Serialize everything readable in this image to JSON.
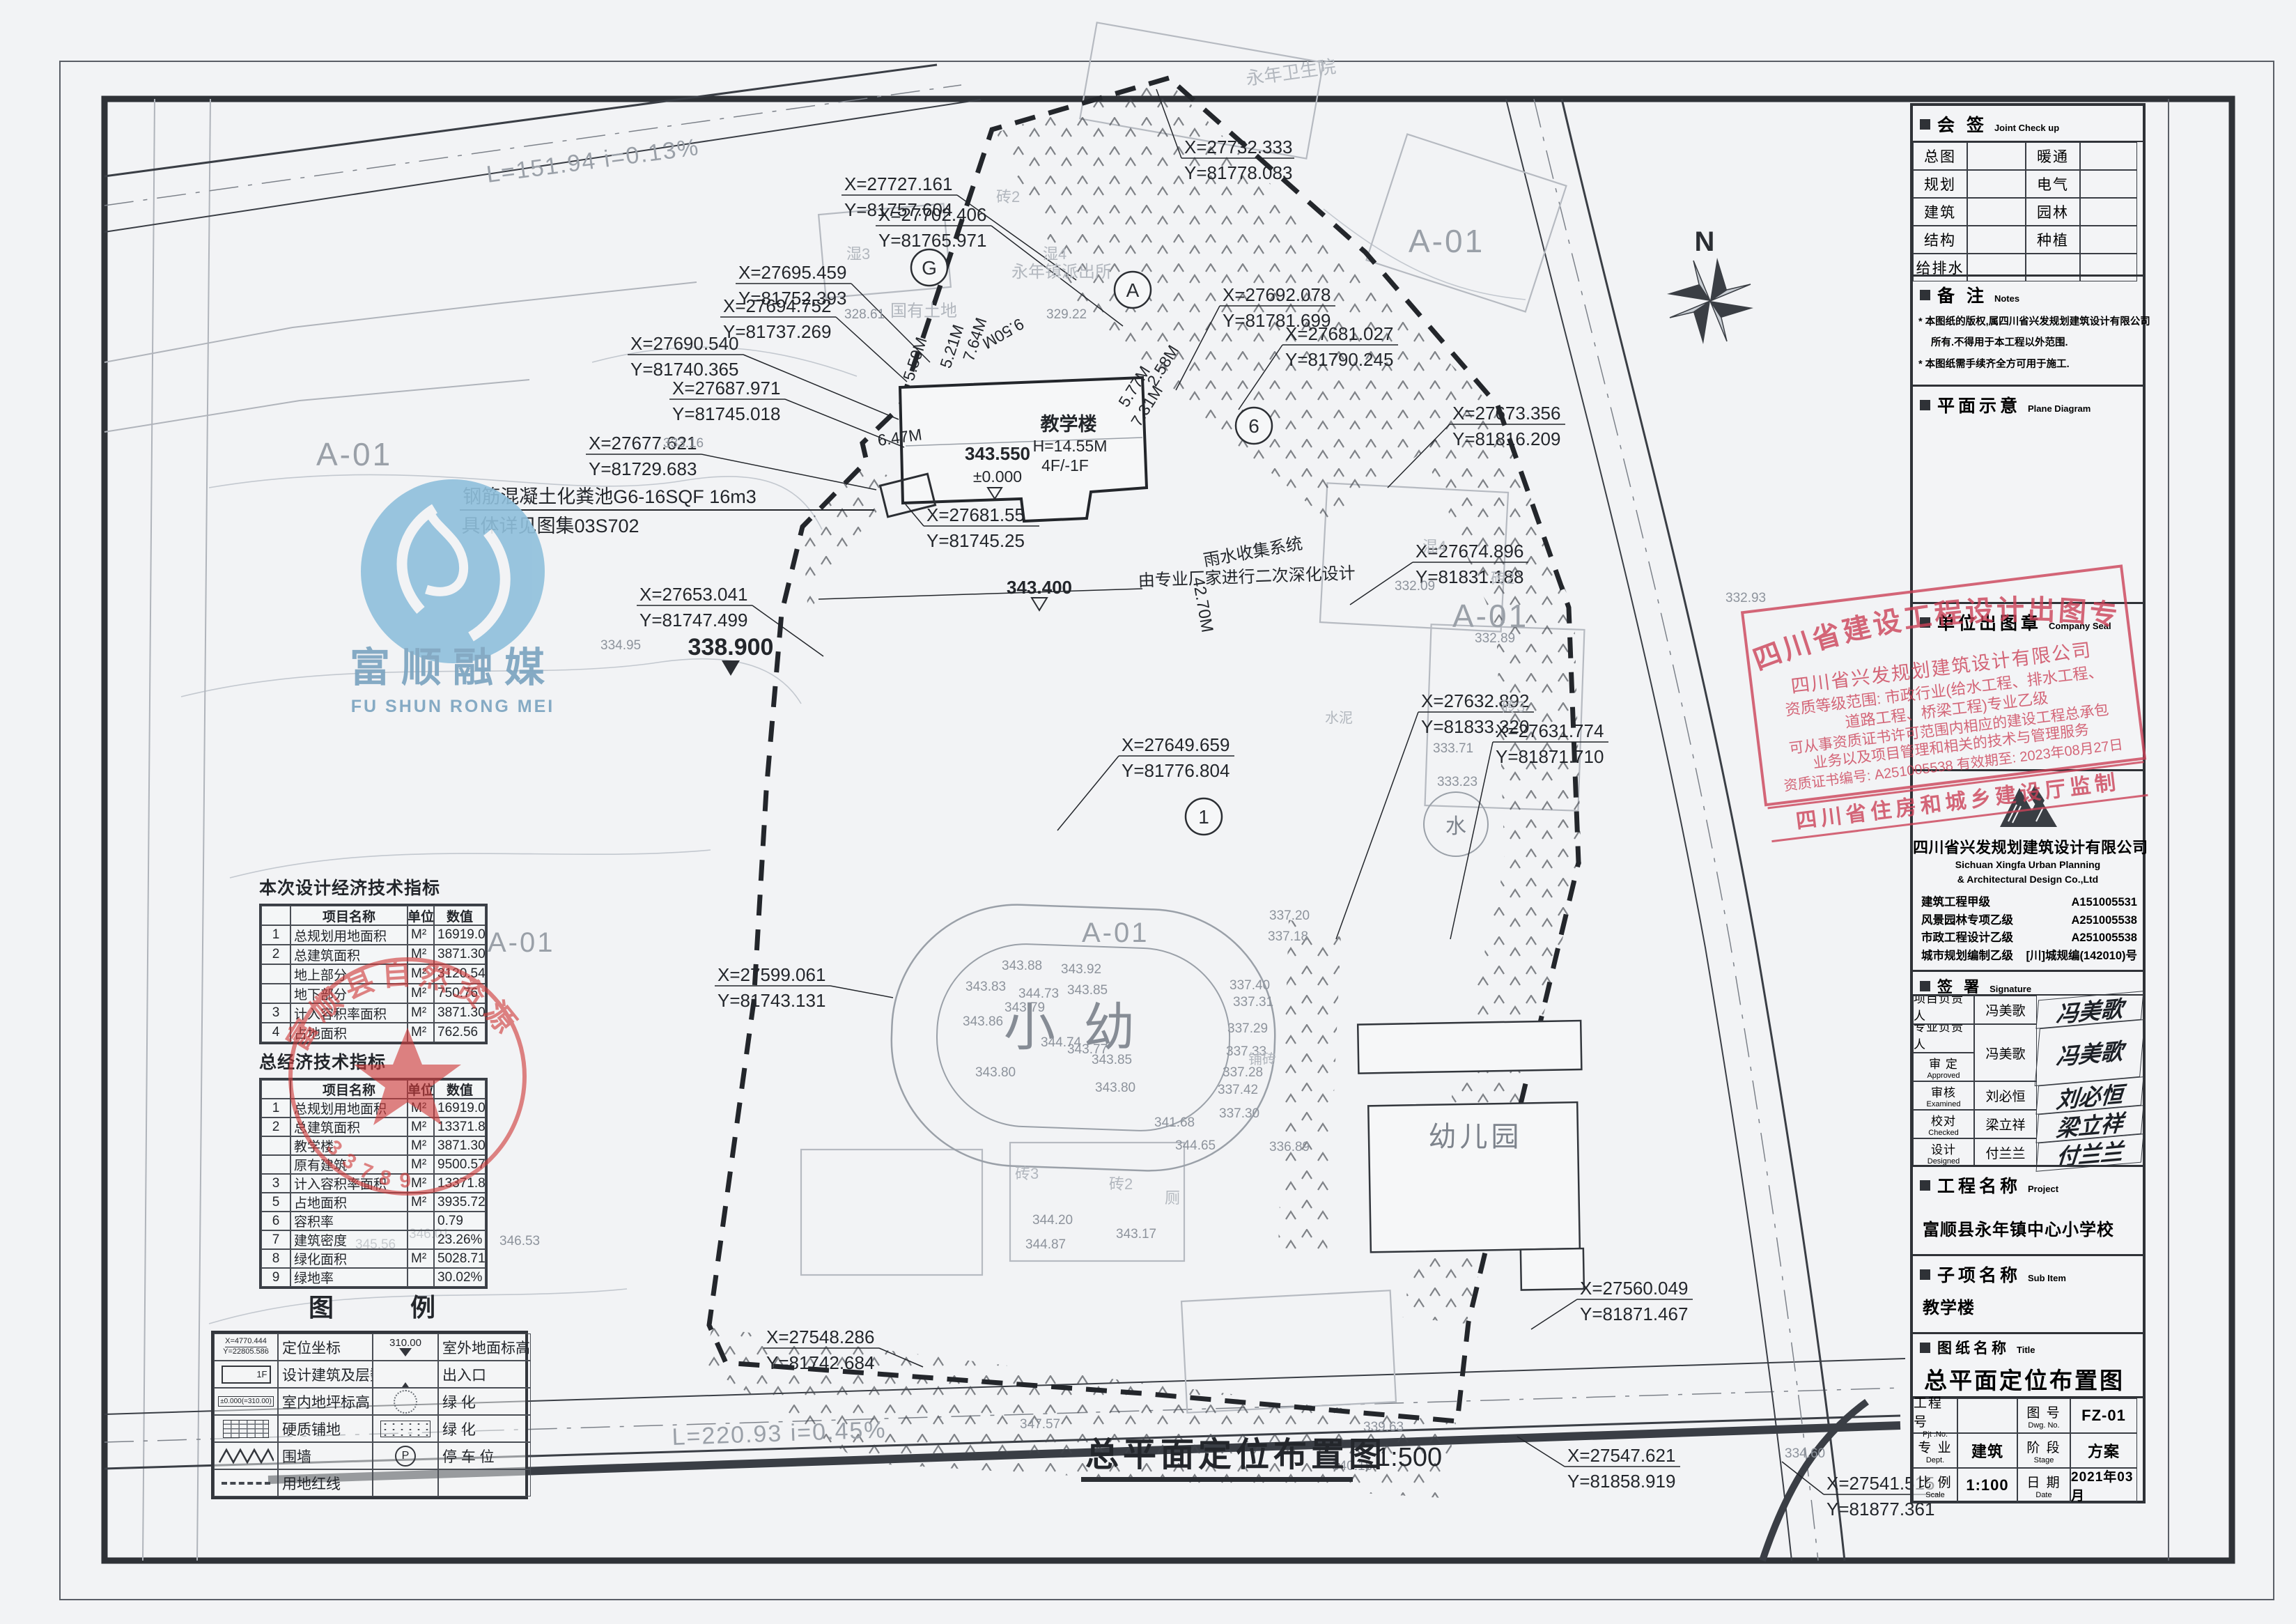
{
  "joint": {
    "hcn": "会 签",
    "hen": "Joint Check up",
    "left": [
      "总图",
      "规划",
      "建筑",
      "结构",
      "给排水"
    ],
    "right": [
      "暖通",
      "电气",
      "园林",
      "种植",
      ""
    ]
  },
  "notes": {
    "hcn": "备 注",
    "hen": "Notes",
    "lines": [
      "* 本图纸的版权,属四川省兴发规划建筑设计有限公司",
      "所有.不得用于本工程以外范围.",
      "* 本图纸需手续齐全方可用于施工."
    ]
  },
  "plane": {
    "hcn": "平面示意",
    "hen": "Plane Diagram"
  },
  "seal": {
    "hcn": "单位出图章",
    "hen": "Company Seal"
  },
  "company": {
    "cn": "四川省兴发规划建筑设计有限公司",
    "en1": "Sichuan Xingfa Urban Planning",
    "en2": "& Architectural Design Co.,Ltd",
    "certs": [
      {
        "l": "建筑工程甲级",
        "n": "A151005531"
      },
      {
        "l": "风景园林专项乙级",
        "n": "A251005538"
      },
      {
        "l": "市政工程设计乙级",
        "n": "A251005538"
      },
      {
        "l": "城市规划编制乙级",
        "n": "[川]城规编(142010)号"
      }
    ]
  },
  "sign": {
    "hcn": "签 署",
    "hen": "Signature",
    "roles": [
      {
        "cn": "项目负责人",
        "en": "Item.Prin"
      },
      {
        "cn": "专业负责人",
        "en": "Chief"
      },
      {
        "cn": "审 定",
        "en": "Approved"
      },
      {
        "cn": "审核",
        "en": "Examined"
      },
      {
        "cn": "校对",
        "en": "Checked"
      },
      {
        "cn": "设计",
        "en": "Designed"
      }
    ],
    "names": [
      "冯美歌",
      "冯美歌",
      "刘必恒",
      "梁立祥",
      "付兰兰"
    ],
    "sigs": [
      "冯美歌",
      "冯美歌",
      "刘必恒",
      "梁立祥",
      "付兰兰"
    ]
  },
  "project": {
    "hcn": "工程名称",
    "hen": "Project",
    "name": "富顺县永年镇中心小学校"
  },
  "sub": {
    "hcn": "子项名称",
    "hen": "Sub Item",
    "name": "教学楼"
  },
  "sheetname": {
    "hcn": "图纸名称",
    "hen": "Title",
    "name": "总平面定位布置图"
  },
  "grid": {
    "pl": "工程号",
    "ple": "Pjt .No.",
    "pv": "",
    "dl": "图 号",
    "dle": "Dwg. No.",
    "dv": "FZ-01",
    "al": "专 业",
    "ale": "Dept.",
    "av": "建筑",
    "sl": "阶 段",
    "sle": "Stage",
    "sv": "方案",
    "bl": "比 例",
    "ble": "Scale",
    "bv": "1:100",
    "tl": "日 期",
    "tle": "Date",
    "tv": "2021年03月"
  },
  "bigstamp": {
    "arc": "四川省建设工程设计出图专用章",
    "l1": "四川省兴发规划建筑设计有限公司",
    "l2": "资质等级范围: 市政行业(给水工程、排水工程、",
    "l3": "道路工程、桥梁工程)专业乙级",
    "l4": "可从事资质证书许可范围内相应的建设工程总承包",
    "l5": "业务以及项目管理和相关的技术与管理服务",
    "l6": "资质证书编号: A251005538  有效期至: 2023年08月27日",
    "footer": "四川省住房和城乡建设厅监制"
  },
  "roundstamp": {
    "arc": "富顺县自然资源局",
    "num": "33789"
  },
  "watermark": {
    "cn": "富顺融媒",
    "en": "FU SHUN RONG MEI"
  },
  "t1": {
    "title": "本次设计经济技术指标",
    "h": [
      "",
      "项目名称",
      "单位",
      "数值"
    ],
    "rows": [
      [
        "1",
        "总规划用地面积",
        "M²",
        "16919.03"
      ],
      [
        "2",
        "总建筑面积",
        "M²",
        "3871.30"
      ],
      [
        "",
        "地上部分",
        "M²",
        "3120.54"
      ],
      [
        "",
        "地下部分",
        "M²",
        "750.76"
      ],
      [
        "3",
        "计入容积率面积",
        "M²",
        "3871.30"
      ],
      [
        "4",
        "占地面积",
        "M²",
        "762.56"
      ]
    ]
  },
  "t2": {
    "title": "总经济技术指标",
    "h": [
      "",
      "项目名称",
      "单位",
      "数值"
    ],
    "rows": [
      [
        "1",
        "总规划用地面积",
        "M²",
        "16919.03"
      ],
      [
        "2",
        "总建筑面积",
        "M²",
        "13371.87"
      ],
      [
        "",
        "教学楼",
        "M²",
        "3871.30"
      ],
      [
        "",
        "原有建筑",
        "M²",
        "9500.57"
      ],
      [
        "3",
        "计入容积率面积",
        "M²",
        "13371.87"
      ],
      [
        "5",
        "占地面积",
        "M²",
        "3935.72"
      ],
      [
        "6",
        "容积率",
        "",
        "0.79"
      ],
      [
        "7",
        "建筑密度",
        "",
        "23.26%"
      ],
      [
        "8",
        "绿化面积",
        "M²",
        "5028.71"
      ],
      [
        "9",
        "绿地率",
        "",
        "30.02%"
      ]
    ]
  },
  "legend": {
    "t1": "图",
    "t2": "例",
    "r1l": "定位坐标",
    "r1r": "室外地面标高",
    "r2l": "设计建筑及层数",
    "r2r": "出入口",
    "r3l": "室内地坪标高",
    "r3r": "绿 化",
    "r4l": "硬质铺地",
    "r4r": "绿 化",
    "r5l": "围墙",
    "r5r": "停 车 位",
    "r6l": "用地红线",
    "cx": "X=4770.444",
    "cy": "Y=22805.586",
    "elev": "310.00",
    "fl": "1F",
    "indoor": "±0.000(=310.00)",
    "pk": "P"
  },
  "d": {
    "caption": "总平面定位布置图",
    "cscale": "1:500",
    "roadtop": "L=151.94 i=0.13%",
    "roadbot": "L=220.93  i=0.45%",
    "north": "N",
    "area": "A-01",
    "septic1": "钢筋混凝土化粪池G6-16SQF 16m3",
    "septic2": "具体详见图集03S702",
    "rain1": "雨水收集系统",
    "rain2": "由专业厂家进行二次深化设计",
    "bname": "教学楼",
    "bh": "H=14.55M",
    "bf": "4F/-1F",
    "lvl1": "343.550",
    "lvl0": "±0.000",
    "lvl2": "343.400",
    "lvl3": "338.900",
    "lvlw": "333.23",
    "dim1": "6.47M",
    "dim2": "5.59M",
    "dim3": "5.21M",
    "dim4": "7.64M",
    "dim5": "9.50M",
    "dim6": "2.58M",
    "dim7": "5.77M",
    "dim8": "7.31M",
    "dimv": "42.70M",
    "kind": "幼儿园",
    "xy": "小 幼",
    "hosp": "永年卫生院",
    "police": "永年镇派出所",
    "land": "国有土地",
    "shi3": "湿3",
    "shi4": "湿4",
    "hun4": "混4",
    "zh2": "砖2",
    "zh3": "砖3",
    "pu": "铺砖",
    "cem": "水泥",
    "wc": "厕",
    "water": "水",
    "bubG": "G",
    "bubA": "A",
    "bub6": "6",
    "bub1": "1",
    "coords": [
      {
        "x": "X=27732.333",
        "y": "Y=81778.083"
      },
      {
        "x": "X=27727.161",
        "y": "Y=81757.604"
      },
      {
        "x": "X=27702.406",
        "y": "Y=81765.971"
      },
      {
        "x": "X=27695.459",
        "y": "Y=81752.393"
      },
      {
        "x": "X=27694.752",
        "y": "Y=81737.269"
      },
      {
        "x": "X=27690.540",
        "y": "Y=81740.365"
      },
      {
        "x": "X=27687.971",
        "y": "Y=81745.018"
      },
      {
        "x": "X=27677.621",
        "y": "Y=81729.683"
      },
      {
        "x": "X=27692.078",
        "y": "Y=81781.699"
      },
      {
        "x": "X=27681.027",
        "y": "Y=81790.245"
      },
      {
        "x": "X=27673.356",
        "y": "Y=81816.209"
      },
      {
        "x": "X=27674.896",
        "y": "Y=81831.188"
      },
      {
        "x": "X=27632.892",
        "y": "Y=81833.320"
      },
      {
        "x": "X=27631.774",
        "y": "Y=81871.710"
      },
      {
        "x": "X=27649.659",
        "y": "Y=81776.804"
      },
      {
        "x": "X=27653.041",
        "y": "Y=81747.499"
      },
      {
        "x": "X=27681.55",
        "y": "Y=81745.25"
      },
      {
        "x": "X=27599.061",
        "y": "Y=81743.131"
      },
      {
        "x": "X=27560.049",
        "y": "Y=81871.467"
      },
      {
        "x": "X=27548.286",
        "y": "Y=81742.684"
      },
      {
        "x": "X=27547.621",
        "y": "Y=81858.919"
      },
      {
        "x": "X=27541.515",
        "y": "Y=81877.361"
      }
    ],
    "spots": [
      "343.88",
      "343.92",
      "344.73",
      "343.85",
      "343.79",
      "343.83",
      "343.86",
      "343.80",
      "344.74",
      "343.77",
      "343.85",
      "343.80",
      "337.20",
      "337.18",
      "337.40",
      "337.31",
      "337.29",
      "337.33",
      "337.28",
      "337.42",
      "337.30",
      "336.89",
      "341.68",
      "344.65",
      "344.20",
      "344.87",
      "343.17",
      "332.09",
      "332.89",
      "333.71",
      "329.22",
      "328.61",
      "333.16",
      "334.95",
      "345.56",
      "346.01",
      "346.53",
      "347.57",
      "339.63",
      "340.18",
      "334.60",
      "332.93"
    ]
  }
}
